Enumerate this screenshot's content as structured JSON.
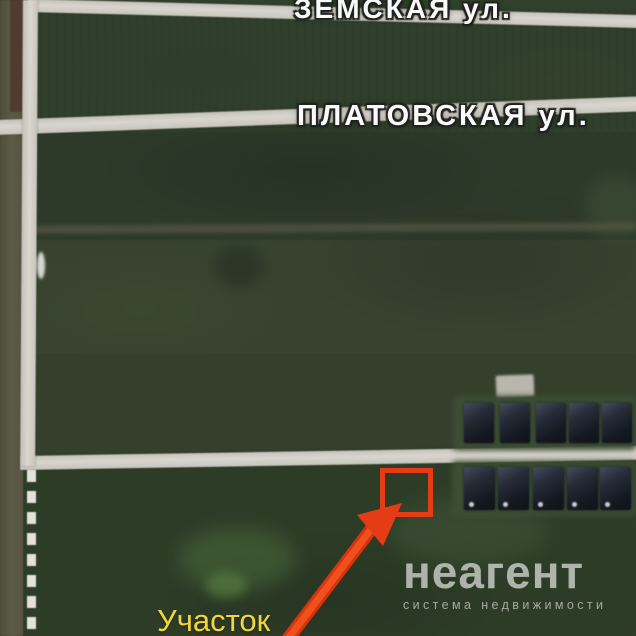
{
  "map": {
    "type": "satellite-imagery-with-annotation",
    "streets": [
      {
        "name": "ЗЕМСКАЯ ул."
      },
      {
        "name": "ПЛАТОВСКАЯ ул."
      }
    ],
    "plot": {
      "label": "Участок",
      "marker": "red-square-outline",
      "pointer": "red-arrow"
    },
    "building_rows": [
      {
        "name": "north-row",
        "count": 5
      },
      {
        "name": "south-row",
        "count": 5
      }
    ],
    "watermark": {
      "brand": "неагент",
      "tagline": "система недвижимости"
    },
    "colors": {
      "annotation_red": "#e63c15",
      "plot_label_yellow": "#f2d53c",
      "street_label_white": "#fafafa",
      "road_gray": "#d1cec6",
      "field_green": "#333f2b",
      "building_dark": "#171b22",
      "watermark_gray": "#cacdc8"
    }
  }
}
